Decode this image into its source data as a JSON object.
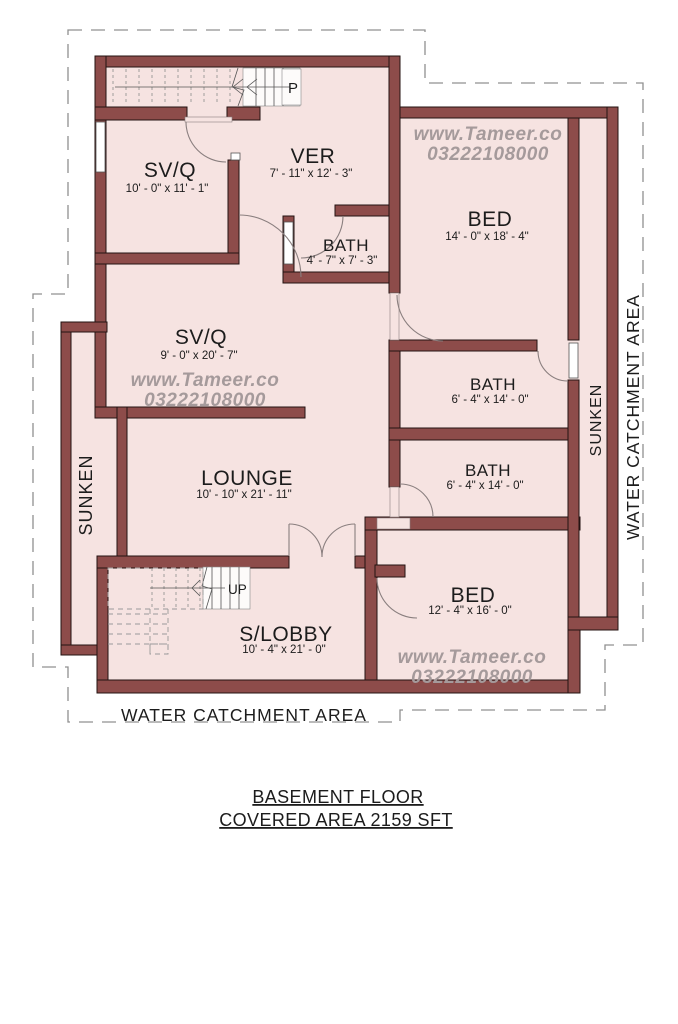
{
  "title": {
    "line1": "BASEMENT FLOOR",
    "line2": "COVERED AREA 2159 SFT"
  },
  "watermark": {
    "line1": "www.Tameer.co",
    "line2": "03222108000"
  },
  "rooms": {
    "svq1": {
      "name": "SV/Q",
      "dims": "10' - 0\" x 11' - 1\""
    },
    "ver": {
      "name": "VER",
      "dims": "7' - 11\" x 12' - 3\""
    },
    "bath_top": {
      "name": "BATH",
      "dims": "4' - 7\" x 7' - 3\""
    },
    "bed_top": {
      "name": "BED",
      "dims": "14' - 0\" x 18' - 4\""
    },
    "svq2": {
      "name": "SV/Q",
      "dims": "9' - 0\" x 20' - 7\""
    },
    "bath_mid": {
      "name": "BATH",
      "dims": "6' - 4\" x 14' - 0\""
    },
    "bath_low": {
      "name": "BATH",
      "dims": "6' - 4\" x 14' - 0\""
    },
    "lounge": {
      "name": "LOUNGE",
      "dims": "10' - 10\" x 21' - 11\""
    },
    "bed_bottom": {
      "name": "BED",
      "dims": "12' - 4\" x 16' - 0\""
    },
    "slobby": {
      "name": "S/LOBBY",
      "dims": "10' - 4\" x 21' - 0\""
    }
  },
  "annotations": {
    "sunken_left": "SUNKEN",
    "sunken_right": "SUNKEN",
    "water_catchment_right": "WATER CATCHMENT AREA",
    "water_catchment_bottom": "WATER CATCHMENT AREA",
    "stair_down_label": "P",
    "stair_up_label": "UP"
  },
  "colors": {
    "wall": "#8d4c4a",
    "room_fill": "#f6e3e1",
    "outline": "#241312",
    "boundary_dash": "#909090",
    "watermark": "#a59a9b",
    "text": "#1c1c1c"
  }
}
